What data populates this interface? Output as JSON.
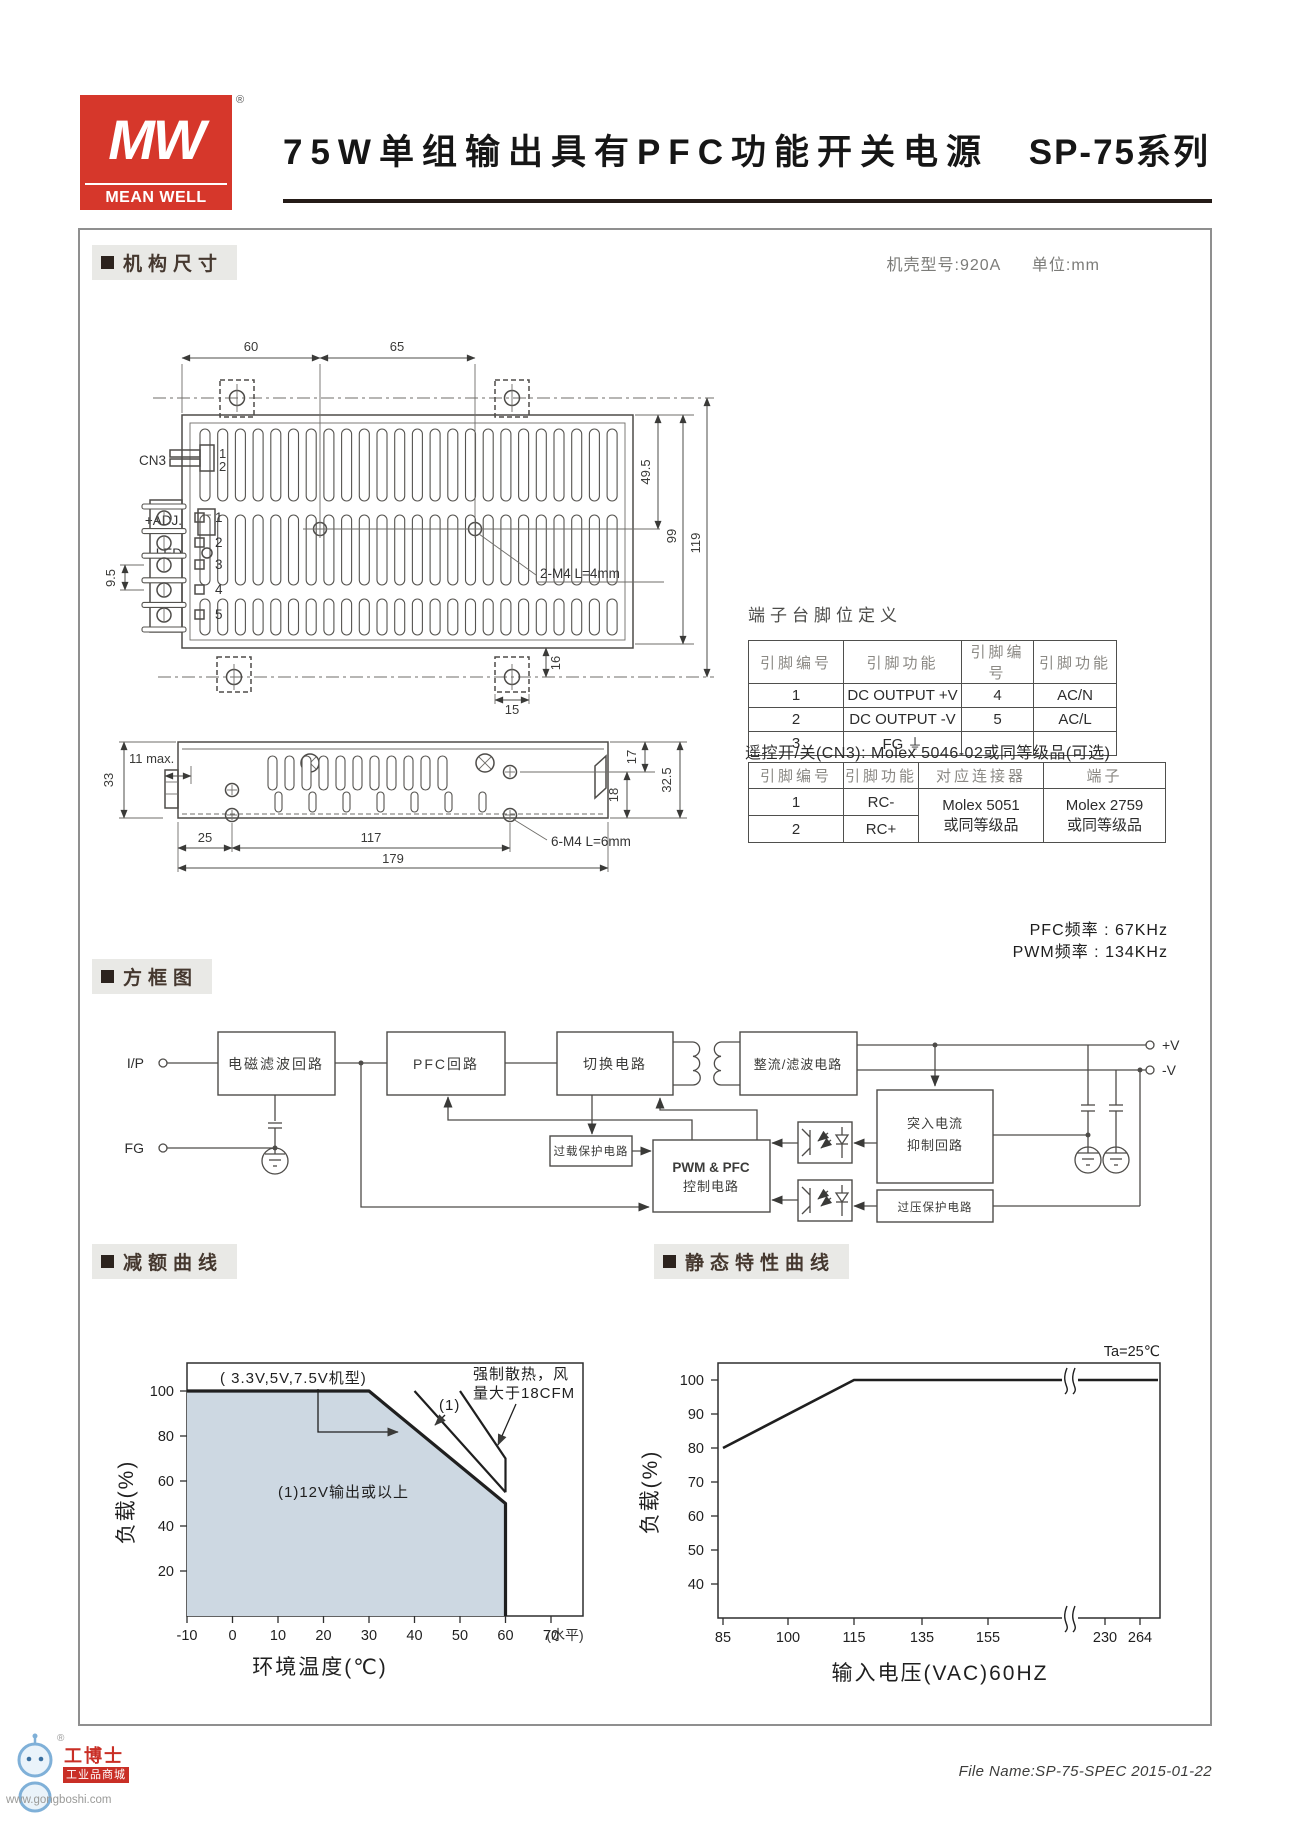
{
  "header": {
    "mw": "MW",
    "brand": "MEAN WELL",
    "reg": "®",
    "title": "75W单组输出具有PFC功能开关电源",
    "series": "SP-75系列"
  },
  "mech": {
    "label": "机构尺寸",
    "case_model": "机壳型号:920A",
    "case_unit": "单位:mm",
    "top": {
      "cn3": "CN3",
      "adj": "+ADJ.",
      "led": "LED",
      "cn3_pins": [
        "1",
        "2"
      ],
      "pins": [
        "1",
        "2",
        "3",
        "4",
        "5"
      ],
      "d60": "60",
      "d65": "65",
      "m4": "2-M4 L=4mm",
      "d495": "49.5",
      "d99": "99",
      "d119": "119",
      "d16": "16",
      "d15": "15",
      "d95": "9.5"
    },
    "side": {
      "d11": "11 max.",
      "d33": "33",
      "d25": "25",
      "d117": "117",
      "d179": "179",
      "m4": "6-M4 L=6mm",
      "d17": "17",
      "d18": "18",
      "d325": "32.5"
    }
  },
  "pin_table": {
    "title": "端子台脚位定义",
    "headers": [
      "引脚编号",
      "引脚功能",
      "引脚编号",
      "引脚功能"
    ],
    "rows": [
      [
        "1",
        "DC OUTPUT +V",
        "4",
        "AC/N"
      ],
      [
        "2",
        "DC OUTPUT -V",
        "5",
        "AC/L"
      ],
      [
        "3",
        "FG ⏚",
        "",
        ""
      ]
    ]
  },
  "cn3_note": "遥控开/关(CN3): Molex 5046-02或同等级品(可选)",
  "cn3_table": {
    "headers": [
      "引脚编号",
      "引脚功能",
      "对应连接器",
      "端子"
    ],
    "rows": [
      [
        "1",
        "RC-"
      ],
      [
        "2",
        "RC+"
      ]
    ],
    "connector": [
      "Molex 5051",
      "或同等级品"
    ],
    "terminal": [
      "Molex 2759",
      "或同等级品"
    ]
  },
  "block": {
    "label": "方框图",
    "pfc_freq": "PFC频率 : 67KHz",
    "pwm_freq": "PWM频率 : 134KHz",
    "ip": "I/P",
    "fg": "FG",
    "vpos": "+V",
    "vneg": "-V",
    "emi": "电磁滤波回路",
    "pfc": "PFC回路",
    "sw": "切换电路",
    "rect": "整流/滤波电路",
    "overload": "过载保护电路",
    "pwm1": "PWM & PFC",
    "pwm2": "控制电路",
    "inrush1": "突入电流",
    "inrush2": "抑制回路",
    "ovp": "过压保护电路"
  },
  "derating_label": "减额曲线",
  "static_label": "静态特性曲线",
  "chart_data": [
    {
      "type": "area",
      "title": "减额曲线",
      "xlabel": "环境温度(℃)",
      "ylabel": "负载(%)",
      "xlim": [
        -10,
        77
      ],
      "ylim": [
        0,
        112
      ],
      "x_ticks": [
        -10,
        0,
        10,
        20,
        30,
        40,
        50,
        60,
        70
      ],
      "x_axis_suffix": "(水平)",
      "y_ticks": [
        20,
        40,
        60,
        80,
        100
      ],
      "grid": false,
      "series": [
        {
          "name": "3.3V,5V,7.5V机型",
          "points": [
            [
              -10,
              100
            ],
            [
              30,
              100
            ],
            [
              60,
              50
            ],
            [
              60,
              0
            ]
          ],
          "style": "thick-filled"
        },
        {
          "name": "(1)12V输出或以上",
          "points": [
            [
              40,
              100
            ],
            [
              60,
              55
            ]
          ],
          "style": "thin"
        },
        {
          "name": "强制散热 风量大于18CFM",
          "points": [
            [
              50,
              100
            ],
            [
              60,
              70
            ],
            [
              60,
              55
            ]
          ],
          "style": "thin"
        }
      ],
      "annotations": {
        "models": "( 3.3V,5V,7.5V机型)",
        "note1": "(1)",
        "forced1": "强制散热，风",
        "forced2": "量大于18CFM",
        "region": "(1)12V输出或以上"
      }
    },
    {
      "type": "line",
      "title": "静态特性曲线",
      "corner_label": "Ta=25℃",
      "xlabel": "输入电压(VAC)60HZ",
      "ylabel": "负载(%)",
      "x_ticks": [
        85,
        100,
        115,
        135,
        155,
        230,
        264
      ],
      "y_ticks": [
        40,
        50,
        60,
        70,
        80,
        90,
        100
      ],
      "axis_break_between": [
        155,
        230
      ],
      "grid": false,
      "series": [
        {
          "name": "负载",
          "points": [
            [
              85,
              80
            ],
            [
              115,
              100
            ],
            [
              264,
              100
            ]
          ]
        }
      ]
    }
  ],
  "footer": {
    "file": "File Name:SP-75-SPEC  2015-01-22"
  },
  "watermark": {
    "name": "工博士",
    "reg": "®",
    "badge": "工业品商城",
    "url": "www.gongboshi.com"
  }
}
